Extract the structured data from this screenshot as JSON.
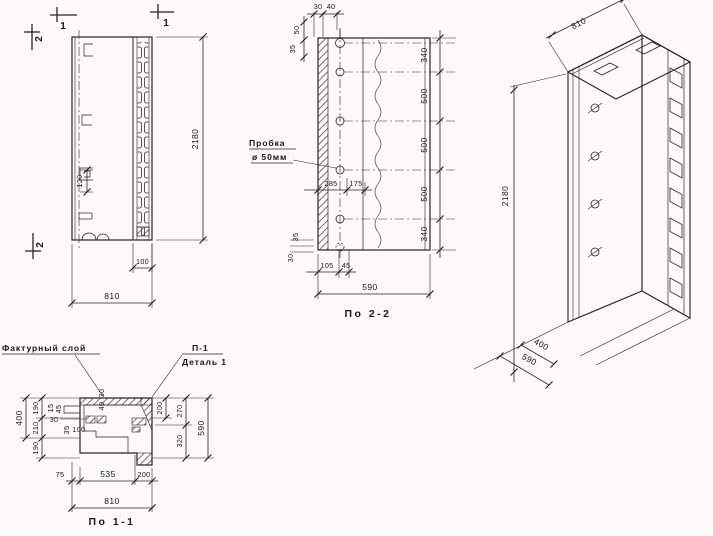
{
  "colors": {
    "ink": "#1f1f22",
    "paper": "#fbfaf6"
  },
  "front": {
    "mark_1_left": "1",
    "mark_1_right": "1",
    "mark_2_top": "2",
    "mark_2_bottom": "2",
    "dim_height": "2180",
    "dim_width": "810",
    "dim_strip_width": "100",
    "dim_detail": "120"
  },
  "sec22": {
    "title": "По 2-2",
    "plug_label": "Пробка",
    "plug_dia": "ø 50мм",
    "dim_top_30": "30",
    "dim_top_40": "40",
    "dim_left_50": "50",
    "dim_left_35": "35",
    "chain": [
      "340",
      "500",
      "500",
      "500",
      "340"
    ],
    "dim_285": "285",
    "dim_175": "175",
    "dim_bot_35": "35",
    "dim_bot_30": "30",
    "dim_105": "105",
    "dim_45": "45",
    "dim_width": "590"
  },
  "iso": {
    "dim_width": "810",
    "dim_height": "2180",
    "dim_400": "400",
    "dim_590": "590"
  },
  "sec11": {
    "title": "По 1-1",
    "label_facing": "Фактурный слой",
    "label_p1": "П-1",
    "label_detail": "Деталь 1",
    "dim_400": "400",
    "chain_left": [
      "190",
      "210",
      "190"
    ],
    "dim_15": "15",
    "dim_45": "45",
    "dim_30_left": "30",
    "dim_35": "35",
    "dim_100": "100",
    "dim_top_30": "30",
    "dim_top_40": "40",
    "dim_200_inner": "200",
    "chain_right": [
      "270",
      "320"
    ],
    "dim_590": "590",
    "dim_75": "75",
    "dim_535": "535",
    "dim_200": "200",
    "dim_810": "810"
  }
}
